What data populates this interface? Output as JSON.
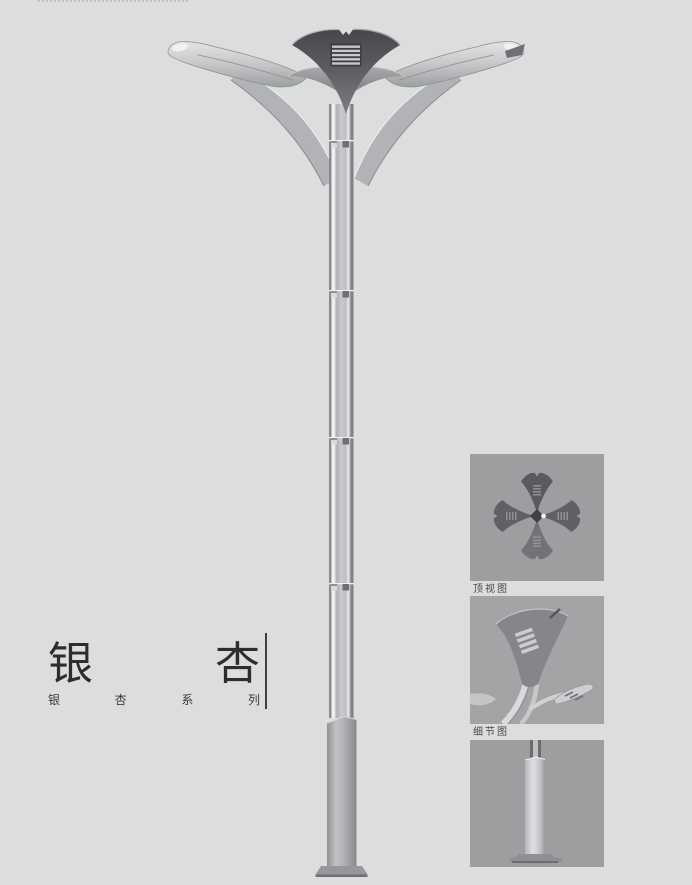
{
  "title": {
    "main": "银杏",
    "series": "银杏系列"
  },
  "thumbnails": [
    {
      "id": "top-view",
      "label": "顶视图"
    },
    {
      "id": "detail-view",
      "label": "细节图"
    },
    {
      "id": "base-view",
      "label": ""
    }
  ],
  "colors": {
    "background": "#dcdddd",
    "panel_background": "#9d9ea0",
    "title_text": "#2c2d2f",
    "divider": "#3e3f42",
    "lamp_dark": "#55555b",
    "lamp_silver": "#b3b4b7"
  }
}
